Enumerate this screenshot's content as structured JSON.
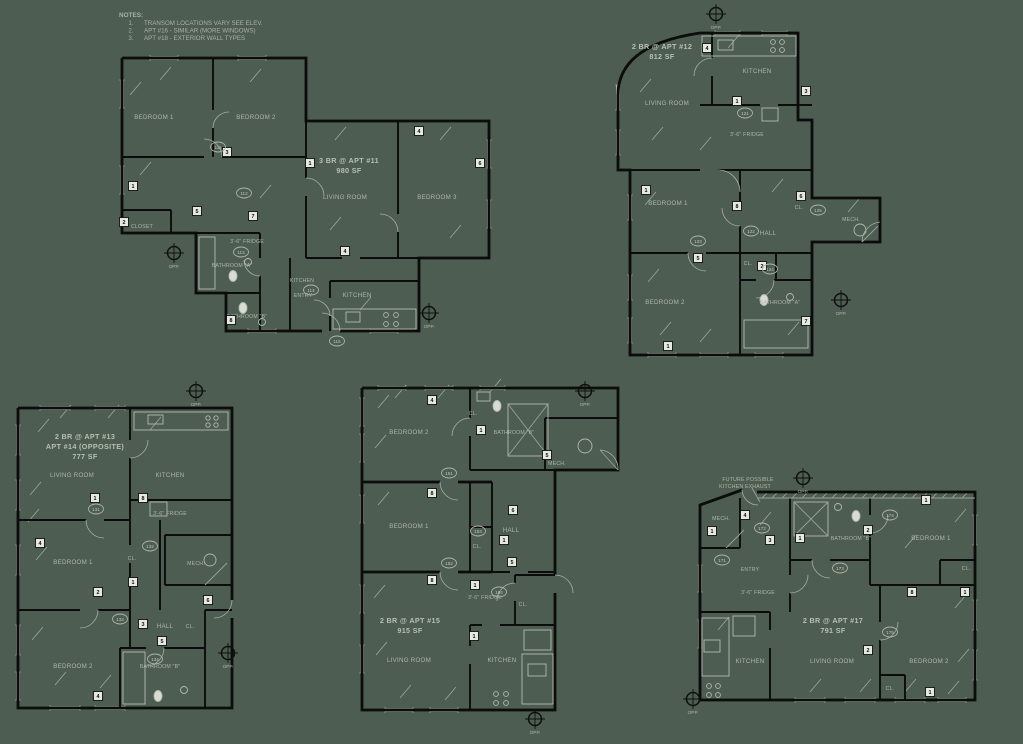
{
  "sheet": {
    "bg": "#4e5d51",
    "ink": "#0b0c0b",
    "annotation_text": "#aeb6ab",
    "tag_fill": "#e6e9e2"
  },
  "notes": {
    "title": "NOTES:",
    "items": [
      {
        "n": "1.",
        "text": "TRANSOM LOCATIONS VARY SEE ELEV."
      },
      {
        "n": "2.",
        "text": "APT #16 - SIMILAR (MORE WINDOWS)"
      },
      {
        "n": "3.",
        "text": "APT #18 - EXTERIOR WALL TYPES"
      }
    ]
  },
  "marker_label": "OPP.",
  "plans": {
    "apt11": {
      "title": "3 BR @ APT #11",
      "area": "980 SF",
      "rooms": {
        "bedroom1": "BEDROOM 1",
        "bedroom2": "BEDROOM 2",
        "living": "LIVING ROOM",
        "bedroom3": "BEDROOM 3",
        "closet": "CLOSET",
        "bath_a": "BATHROOM \"A\"",
        "bath_b": "BATHROOM \"B\"",
        "kitchen2": "KITCHEN",
        "entry": "ENTRY",
        "kitchen": "KITCHEN",
        "fridge": "3'-6\" FRIDGE"
      },
      "squares": [
        {
          "n": "1",
          "x": 133,
          "y": 186
        },
        {
          "n": "2",
          "x": 124,
          "y": 222
        },
        {
          "n": "3",
          "x": 227,
          "y": 152
        },
        {
          "n": "5",
          "x": 197,
          "y": 211
        },
        {
          "n": "4",
          "x": 419,
          "y": 131
        },
        {
          "n": "6",
          "x": 480,
          "y": 163
        },
        {
          "n": "7",
          "x": 253,
          "y": 216
        },
        {
          "n": "8",
          "x": 231,
          "y": 320
        },
        {
          "n": "1",
          "x": 310,
          "y": 163
        },
        {
          "n": "4",
          "x": 345,
          "y": 251
        }
      ],
      "doors": [
        {
          "n": "111",
          "x": 218,
          "y": 147
        },
        {
          "n": "112",
          "x": 244,
          "y": 193
        },
        {
          "n": "113",
          "x": 241,
          "y": 252
        },
        {
          "n": "114",
          "x": 311,
          "y": 290
        },
        {
          "n": "115",
          "x": 337,
          "y": 341
        }
      ]
    },
    "apt12": {
      "title": "2 BR @ APT #12",
      "area": "812 SF",
      "rooms": {
        "kitchen": "KITCHEN",
        "living": "LIVING ROOM",
        "fridge": "3'-6\" FRIDGE",
        "bedroom1": "BEDROOM 1",
        "hall": "HALL",
        "cl1": "CL.",
        "mech": "MECH.",
        "bedroom2": "BEDROOM 2",
        "bath_a": "BATHROOM \"A\"",
        "cl2": "CL."
      },
      "squares": [
        {
          "n": "4",
          "x": 707,
          "y": 48
        },
        {
          "n": "1",
          "x": 737,
          "y": 101
        },
        {
          "n": "3",
          "x": 806,
          "y": 91
        },
        {
          "n": "1",
          "x": 646,
          "y": 190
        },
        {
          "n": "8",
          "x": 737,
          "y": 206
        },
        {
          "n": "6",
          "x": 801,
          "y": 196
        },
        {
          "n": "5",
          "x": 698,
          "y": 258
        },
        {
          "n": "2",
          "x": 762,
          "y": 266
        },
        {
          "n": "7",
          "x": 806,
          "y": 321
        },
        {
          "n": "1",
          "x": 668,
          "y": 346
        }
      ],
      "doors": [
        {
          "n": "121",
          "x": 745,
          "y": 113
        },
        {
          "n": "122",
          "x": 751,
          "y": 231
        },
        {
          "n": "123",
          "x": 698,
          "y": 241
        },
        {
          "n": "124",
          "x": 770,
          "y": 269
        },
        {
          "n": "125",
          "x": 818,
          "y": 210
        }
      ]
    },
    "apt13": {
      "title": "2 BR @ APT #13",
      "title2": "APT #14 (OPPOSITE)",
      "area": "777 SF",
      "rooms": {
        "living": "LIVING ROOM",
        "kitchen": "KITCHEN",
        "fridge": "3'-6\" FRIDGE",
        "bedroom1": "BEDROOM 1",
        "cl1": "CL.",
        "mech": "MECH.",
        "hall": "HALL",
        "cl2": "CL.",
        "bedroom2": "BEDROOM 2",
        "bath_b": "BATHROOM \"B\""
      },
      "squares": [
        {
          "n": "1",
          "x": 95,
          "y": 498
        },
        {
          "n": "8",
          "x": 143,
          "y": 498
        },
        {
          "n": "4",
          "x": 40,
          "y": 543
        },
        {
          "n": "2",
          "x": 98,
          "y": 592
        },
        {
          "n": "1",
          "x": 133,
          "y": 582
        },
        {
          "n": "3",
          "x": 143,
          "y": 624
        },
        {
          "n": "6",
          "x": 208,
          "y": 600
        },
        {
          "n": "5",
          "x": 162,
          "y": 641
        },
        {
          "n": "4",
          "x": 98,
          "y": 696
        }
      ],
      "doors": [
        {
          "n": "131",
          "x": 96,
          "y": 509
        },
        {
          "n": "132",
          "x": 150,
          "y": 546
        },
        {
          "n": "133",
          "x": 120,
          "y": 619
        },
        {
          "n": "134",
          "x": 155,
          "y": 659
        }
      ]
    },
    "apt15": {
      "title": "2 BR @ APT #15",
      "area": "915 SF",
      "rooms": {
        "bedroom2": "BEDROOM 2",
        "bath_b": "BATHROOM \"B\"",
        "mech": "MECH.",
        "cl1": "CL.",
        "bedroom1": "BEDROOM 1",
        "hall": "HALL",
        "cl2": "CL.",
        "cl3": "CL.",
        "fridge": "3'-6\" FRIDGE",
        "living": "LIVING ROOM",
        "kitchen": "KITCHEN"
      },
      "squares": [
        {
          "n": "4",
          "x": 432,
          "y": 400
        },
        {
          "n": "1",
          "x": 481,
          "y": 430
        },
        {
          "n": "8",
          "x": 432,
          "y": 493
        },
        {
          "n": "5",
          "x": 547,
          "y": 455
        },
        {
          "n": "6",
          "x": 513,
          "y": 510
        },
        {
          "n": "1",
          "x": 504,
          "y": 540
        },
        {
          "n": "5",
          "x": 512,
          "y": 562
        },
        {
          "n": "1",
          "x": 475,
          "y": 585
        },
        {
          "n": "8",
          "x": 432,
          "y": 580
        },
        {
          "n": "1",
          "x": 474,
          "y": 636
        }
      ],
      "doors": [
        {
          "n": "151",
          "x": 449,
          "y": 473
        },
        {
          "n": "152",
          "x": 449,
          "y": 563
        },
        {
          "n": "153",
          "x": 478,
          "y": 531
        },
        {
          "n": "154",
          "x": 499,
          "y": 592
        }
      ]
    },
    "apt17": {
      "title": "2 BR @ APT #17",
      "area": "791 SF",
      "note1": "FUTURE POSSIBLE",
      "note2": "KITCHEN EXHAUST",
      "rooms": {
        "mech": "MECH.",
        "entry": "ENTRY",
        "fridge": "3'-6\" FRIDGE",
        "bath_b": "BATHROOM \"B\"",
        "bedroom1": "BEDROOM 1",
        "cl1": "CL.",
        "kitchen": "KITCHEN",
        "living": "LIVING ROOM",
        "bedroom2": "BEDROOM 2",
        "cl2": "CL."
      },
      "squares": [
        {
          "n": "4",
          "x": 745,
          "y": 515
        },
        {
          "n": "1",
          "x": 712,
          "y": 531
        },
        {
          "n": "3",
          "x": 770,
          "y": 540
        },
        {
          "n": "1",
          "x": 800,
          "y": 538
        },
        {
          "n": "2",
          "x": 868,
          "y": 530
        },
        {
          "n": "1",
          "x": 926,
          "y": 500
        },
        {
          "n": "8",
          "x": 912,
          "y": 592
        },
        {
          "n": "2",
          "x": 868,
          "y": 650
        },
        {
          "n": "1",
          "x": 930,
          "y": 692
        },
        {
          "n": "1",
          "x": 965,
          "y": 592
        }
      ],
      "doors": [
        {
          "n": "171",
          "x": 722,
          "y": 560
        },
        {
          "n": "172",
          "x": 762,
          "y": 528
        },
        {
          "n": "173",
          "x": 840,
          "y": 568
        },
        {
          "n": "174",
          "x": 890,
          "y": 515
        },
        {
          "n": "175",
          "x": 890,
          "y": 632
        }
      ]
    }
  },
  "markers": [
    {
      "x": 716,
      "y": 14
    },
    {
      "x": 174,
      "y": 253
    },
    {
      "x": 429,
      "y": 313
    },
    {
      "x": 841,
      "y": 300
    },
    {
      "x": 585,
      "y": 391
    },
    {
      "x": 196,
      "y": 391
    },
    {
      "x": 228,
      "y": 653
    },
    {
      "x": 535,
      "y": 719
    },
    {
      "x": 693,
      "y": 699
    },
    {
      "x": 803,
      "y": 478
    }
  ]
}
